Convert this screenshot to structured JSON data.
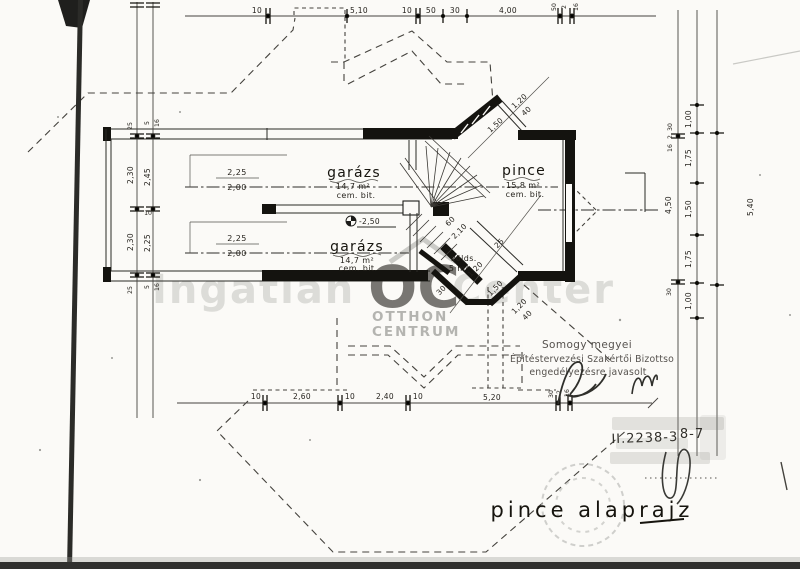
{
  "drawing": {
    "title": "pince alaprajz",
    "type": "basement floor plan (scanned blueprint)"
  },
  "rooms": {
    "garage_top": {
      "name": "garázs",
      "area": "14,7 m²",
      "finish": "cem. bit."
    },
    "garage_bottom": {
      "name": "garázs",
      "area": "14,7 m²",
      "finish": "cem. bit."
    },
    "cellar": {
      "name": "pince",
      "area": "15,8 m²",
      "finish": "cem. bit."
    },
    "storage": {
      "name": "zölds.",
      "area": "5 m²"
    }
  },
  "marks": {
    "floor_level": "-2,50",
    "lintel_top": {
      "num": "2,25",
      "den": "2,00"
    },
    "lintel_bottom": {
      "num": "2,25",
      "den": "2,00"
    }
  },
  "dims": {
    "top": [
      "10",
      "5,10",
      "10",
      "50",
      "30",
      "4,00",
      "50",
      "2",
      "16"
    ],
    "bottom": [
      "10",
      "2,60",
      "10",
      "2,40",
      "10",
      "5,20",
      "30",
      "2",
      "16"
    ],
    "left_outer": [
      "25",
      "2,30",
      "2,30",
      "25"
    ],
    "left_inner": [
      "5",
      "16",
      "2,45",
      "10",
      "2,25",
      "16",
      "5"
    ],
    "right_outer": [
      "30",
      "2",
      "16",
      "4,50",
      "30"
    ],
    "right_mid": [
      "1,00",
      "1,75",
      "1,50",
      "1,75",
      "1,00"
    ],
    "right_total": "5,40",
    "diagonal": [
      "1,20",
      "40",
      "1,50",
      "60",
      "2,10",
      "25",
      "1,20",
      "30",
      "1,50",
      "1,20",
      "40"
    ]
  },
  "approval_stamp": {
    "line1": "Somogy megyei",
    "line2": "Építéstervezési Szakértői Bizottso",
    "line3": "engedélyezésre javasolt"
  },
  "handwritten": {
    "file_number": "II.2238-3",
    "sheet": "8-7"
  },
  "watermark": {
    "text_left": "Ingatlan",
    "text_right": "Center",
    "logo": "OC",
    "brand_line1": "OTTHON",
    "brand_line2": "CENTRUM"
  },
  "colors": {
    "ink": "#1c1c1a",
    "paper": "#fbfaf7",
    "watermark_gray": "#c4c4c0",
    "logo_gray": "#9c9c98",
    "stamp_ink": "#56524e"
  }
}
